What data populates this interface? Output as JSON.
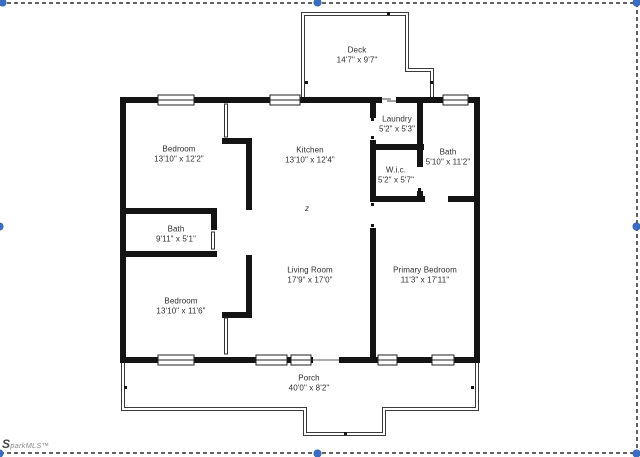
{
  "plan": {
    "rooms": [
      {
        "name": "Deck",
        "dims": "14'7\" x 9'7\""
      },
      {
        "name": "Bedroom",
        "dims": "13'10\" x 12'2\""
      },
      {
        "name": "Kitchen",
        "dims": "13'10\" x 12'4\""
      },
      {
        "name": "Laundry",
        "dims": "5'2\" x 5'3\""
      },
      {
        "name": "Bath",
        "dims": "5'10\" x 11'2\""
      },
      {
        "name": "W.i.c.",
        "dims": "5'2\" x 5'7\""
      },
      {
        "name": "Living Room",
        "dims": "17'9\" x 17'0\""
      },
      {
        "name": "Primary Bedroom",
        "dims": "11'3\" x 17'11\""
      },
      {
        "name": "Bath",
        "dims": "9'11\" x 5'1\""
      },
      {
        "name": "Bedroom",
        "dims": "13'10\" x 11'6\""
      },
      {
        "name": "Porch",
        "dims": "40'0\" x 8'2\""
      }
    ],
    "stray_mark": "z",
    "wall_color": "#141414"
  },
  "watermark": {
    "text": "SparkMLS™"
  },
  "selection": {
    "handle_color": "#3a6ec5",
    "border_color": "#4f4f4f"
  }
}
